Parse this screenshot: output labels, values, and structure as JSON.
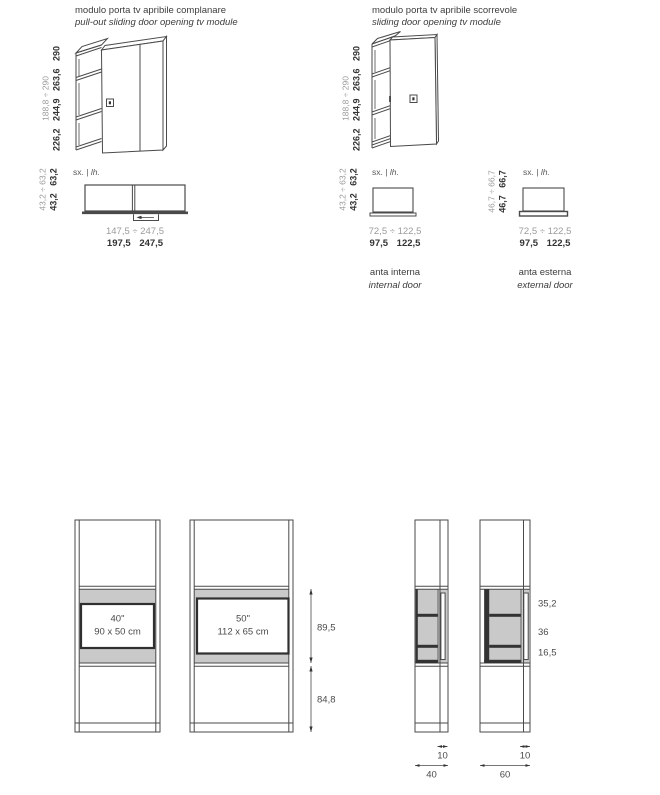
{
  "colors": {
    "line": "#4a4a4a",
    "muted": "#9b9b9b",
    "dark": "#333333",
    "gray_fill": "#c9c9c9",
    "dim_text": "#4b4b4b"
  },
  "top": {
    "module1": {
      "title_it": "modulo porta tv apribile complanare",
      "title_en": "pull-out sliding door opening tv module",
      "height_range": "188,8 ÷ 290",
      "heights": "226,2 244,9 263,6 290"
    },
    "module2": {
      "title_it": "modulo porta tv apribile scorrevole",
      "title_en": "sliding door opening tv module",
      "height_range": "188,8 ÷ 290",
      "heights": "226,2 244,9 263,6 290"
    }
  },
  "plans": {
    "side_label": {
      "sx": "sx.",
      "sep": "|",
      "lh": "lh."
    },
    "full": {
      "depth_range": "43,2 ÷ 63,2",
      "depths": "43,2 63,2",
      "width_range": "147,5 ÷ 247,5",
      "widths": "197,5 247,5"
    },
    "internal": {
      "depth_range": "43,2 ÷ 63,2",
      "depths": "43,2 63,2",
      "width_range": "72,5 ÷ 122,5",
      "widths": "97,5 122,5",
      "caption_it": "anta interna",
      "caption_en": "internal door"
    },
    "external": {
      "depth_range": "46,7 ÷ 66,7",
      "depths": "46,7 66,7",
      "width_range": "72,5 ÷ 122,5",
      "widths": "97,5 122,5",
      "caption_it": "anta esterna",
      "caption_en": "external door"
    }
  },
  "front": {
    "tv40": {
      "size": "40\"",
      "cm": "90 x 50 cm"
    },
    "tv50": {
      "size": "50\"",
      "cm": "112 x 65 cm"
    },
    "tv_zone_height": "89,5",
    "base_height": "84,8"
  },
  "side": {
    "top_shelf": "35,2",
    "middle_shelf": "36",
    "bottom_shelf": "16,5",
    "door_depth": "10",
    "total_depth_40": "40",
    "total_depth_60": "60"
  }
}
